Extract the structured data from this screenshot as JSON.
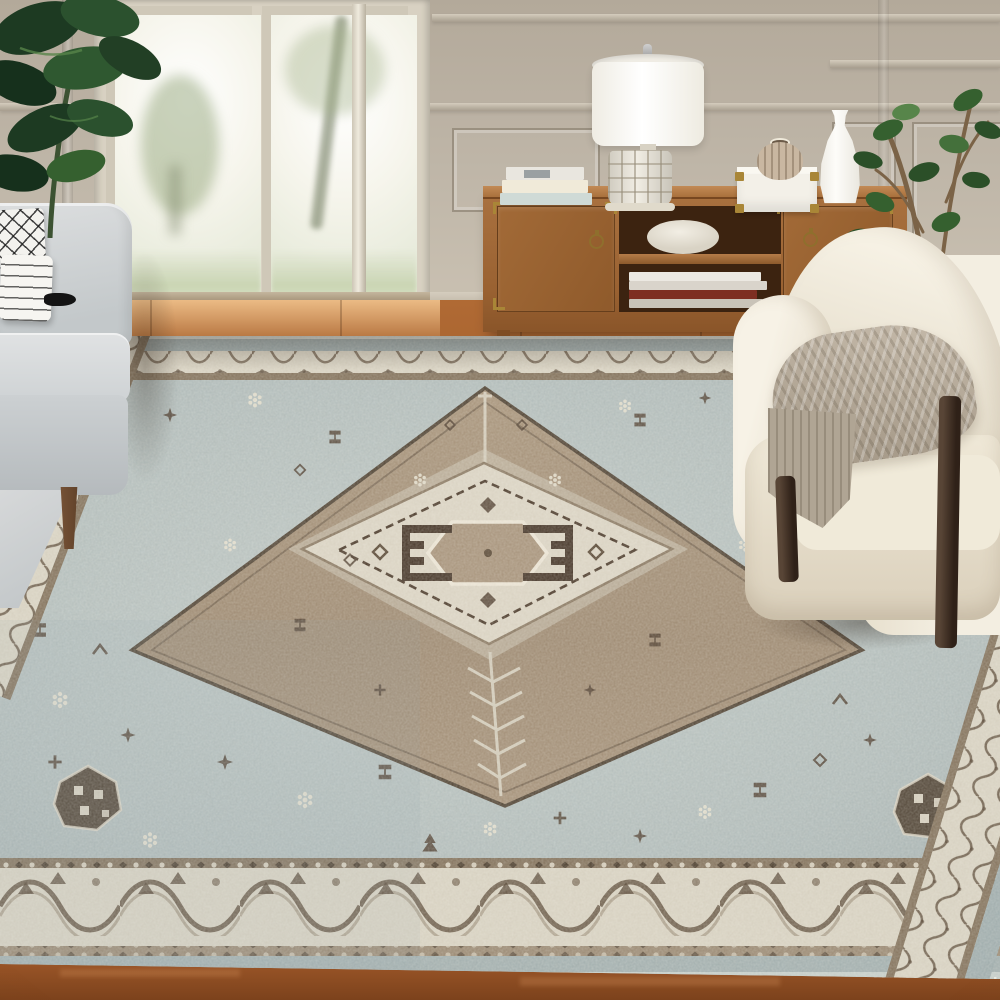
{
  "scene": {
    "description": "Bright living room product photograph showcasing a large vintage-style distressed oriental area rug in beige, brown and light blue, styled with a light gray sofa, a cream boucle barrel armchair with a taupe knit throw, a walnut media console with brass hardware holding a lamp, books and vases, houseplants, greige paneled walls and French doors opening to a sunlit garden over warm hardwood floors.",
    "objects": [
      {
        "name": "area-rug",
        "label": "Distressed vintage medallion area rug in beige, brown and light blue"
      },
      {
        "name": "sofa",
        "label": "Light gray fabric sofa"
      },
      {
        "name": "pillow-lattice",
        "label": "White pillow with black lattice pattern"
      },
      {
        "name": "pillow-striped",
        "label": "White pillow with black stripes and black tassel"
      },
      {
        "name": "armchair",
        "label": "Cream boucle barrel armchair with dark wood frame"
      },
      {
        "name": "throw-blanket",
        "label": "Taupe knit throw blanket"
      },
      {
        "name": "media-console",
        "label": "Walnut media console with brass campaign hardware"
      },
      {
        "name": "table-lamp",
        "label": "Table lamp with white drum shade and textured ceramic base"
      },
      {
        "name": "book-stack",
        "label": "Stack of hardcover books"
      },
      {
        "name": "decor-box",
        "label": "White keepsake box with brass corners"
      },
      {
        "name": "ribbed-vase",
        "label": "Small ribbed stone vase"
      },
      {
        "name": "white-vase",
        "label": "Tall white ceramic vase"
      },
      {
        "name": "shelf-bowl",
        "label": "White bowl on console shelf"
      },
      {
        "name": "shelf-books",
        "label": "Books lying on lower console shelf"
      },
      {
        "name": "fiddle-leaf-plant",
        "label": "Dark green leafy houseplant"
      },
      {
        "name": "ficus-plant",
        "label": "Potted ficus tree"
      },
      {
        "name": "french-doors",
        "label": "French doors with sunlit garden view"
      },
      {
        "name": "paneled-wall",
        "label": "Greige wall with picture-frame molding and chair rail"
      },
      {
        "name": "wood-floor",
        "label": "Warm chestnut hardwood floor"
      }
    ],
    "palette": {
      "wall": "#bdb3a5",
      "wallShadow": "#a89e8f",
      "trimLight": "#d2cabb",
      "doorFrame": "#d8d1c2",
      "glass": "#f7f5ef",
      "floor": "#a55f2c",
      "floorLight": "#c98647",
      "floorDark": "#7e431d",
      "sofa": "#d5d8d9",
      "sofaShadow": "#b7bcbf",
      "pillow": "#f3f2ee",
      "console": "#a26a38",
      "consoleDark": "#8a5529",
      "consoleTop": "#bb8350",
      "consoleInner": "#3c2310",
      "brass": "#a98637",
      "lampShade": "#fbfaf6",
      "lampBase": "#ece7da",
      "boxWhite": "#f3f0e8",
      "vaseBeige": "#c9b7a1",
      "vaseWhite": "#f8f6f1",
      "chair": "#efe9da",
      "chairShadow": "#d7cdb9",
      "chairWood": "#46342a",
      "throw": "#b5aa9b",
      "throwDark": "#9a8e7d",
      "plantDark": "#22401f",
      "plantMid": "#35602f",
      "plantLight": "#57854a",
      "stem": "#7b6347",
      "rugBlue": "#b2bdbd",
      "rugBlueDeep": "#9fadae",
      "rugIvory": "#d9d3c3",
      "rugTan": "#a28e76",
      "rugBrown": "#83725c",
      "rugDark": "#4c3b2c",
      "rugEdge": "#c3ccc8"
    }
  }
}
